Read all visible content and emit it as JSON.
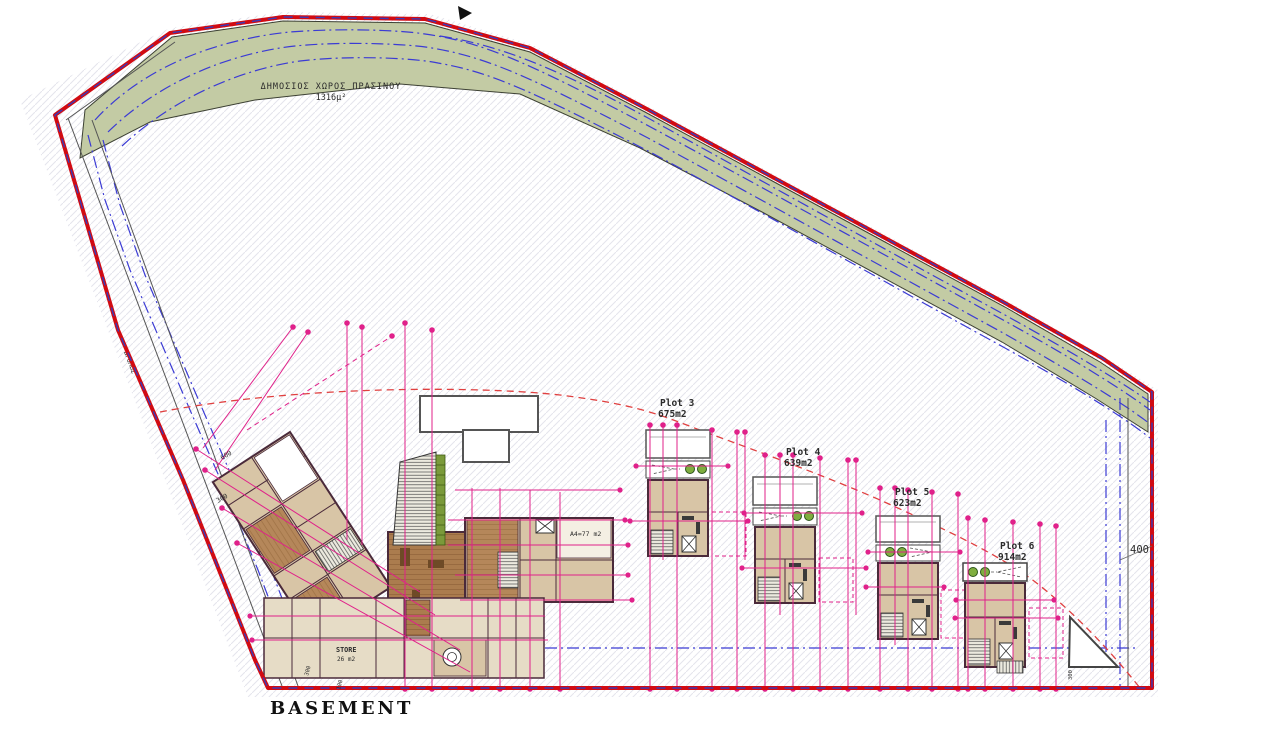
{
  "drawing": {
    "title": "BASEMENT",
    "green_space": {
      "label": "ΔΗΜΟΣΙΟΣ ΧΩΡΟΣ ΠΡΑΣΙΝΟΥ",
      "area": "1316μ²"
    },
    "road_label": "ΔΡΟΜΟΣ",
    "plots": [
      {
        "name": "Plot 3",
        "area": "675m2",
        "area_color": "#222222"
      },
      {
        "name": "Plot 4",
        "area": "639m2",
        "area_color": "#9b2d1f"
      },
      {
        "name": "Plot 5",
        "area": "623m2",
        "area_color": "#222222"
      },
      {
        "name": "Plot 6",
        "area": "914m2",
        "area_color": "#9b2d1f"
      }
    ],
    "labels": {
      "store": "STORE",
      "store_area": "26 m2",
      "unit_a4": "A4=77 m2"
    },
    "dimensions": {
      "right": "400",
      "left_upper": "600",
      "left_lower": "300",
      "bottom_left_1": "300",
      "bottom_left_2": "100",
      "bottom_right": "300"
    },
    "colors": {
      "boundary": "#d10b12",
      "boundary_overlay_dash": "#3a3ab8",
      "green_area": "#c3cba4",
      "utility_line": "#3b3bd4",
      "survey_line": "#e0218a",
      "contour_dashed": "#e04040",
      "room_tan": "#d8c5a6",
      "wood_floor": "#ab7c4e",
      "wall": "#4a2a3a"
    }
  }
}
